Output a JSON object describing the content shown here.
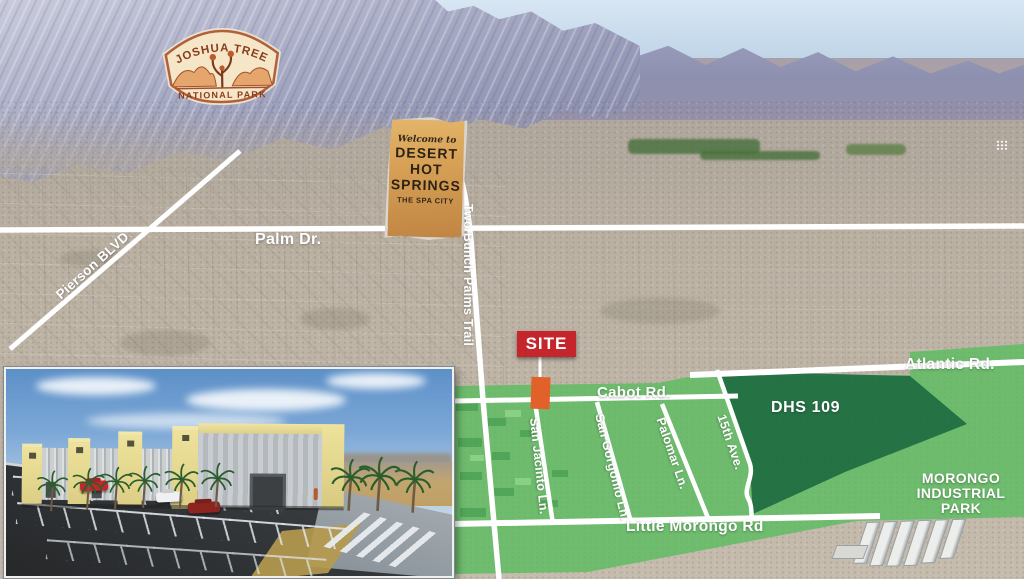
{
  "map": {
    "badges": {
      "joshua_tree": {
        "top": "JOSHUA TREE",
        "bottom": "NATIONAL PARK"
      },
      "dhs_sign": {
        "script": "Welcome to",
        "line1": "DESERT",
        "line2": "HOT",
        "line3": "SPRINGS",
        "tagline": "THE SPA CITY"
      }
    },
    "roads": {
      "palm": "Palm Dr.",
      "pierson": "Pierson BLVD",
      "two_bunch": "Two Bunch Palms Trail",
      "cabot": "Cabot Rd.",
      "atlantic": "Atlantic Rd.",
      "little_morongo": "Little Morongo Rd",
      "san_jacinto": "San Jacinto Ln.",
      "san_gorgonio": "San Gorgonio Ln.",
      "palomar": "Palomar Ln.",
      "fifteenth": "15th Ave."
    },
    "site": {
      "label": "SITE"
    },
    "parcels": {
      "dhs109": "DHS 109",
      "morongo_line1": "MORONGO",
      "morongo_line2": "INDUSTRIAL",
      "morongo_line3": "PARK"
    },
    "colors": {
      "overlay_green": "#57bd5e",
      "parcel_green": "#1e6b41",
      "site_red": "#c4262c",
      "site_orange": "#e2612b",
      "road_white": "#ffffff"
    }
  }
}
